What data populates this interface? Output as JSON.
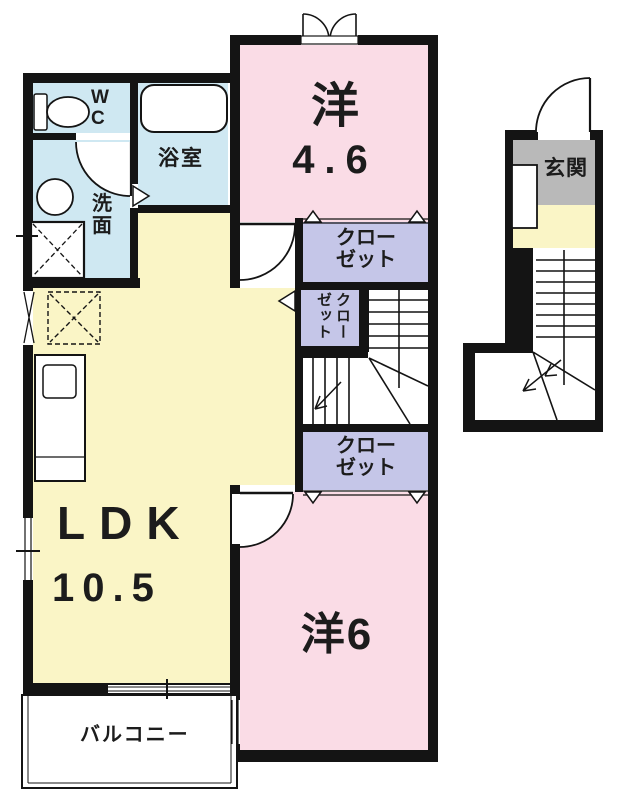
{
  "rooms": {
    "western46": {
      "label": "洋",
      "size": "4.6"
    },
    "western6": {
      "label": "洋6"
    },
    "ldk": {
      "label": "LDK",
      "size": "10.5"
    },
    "bathroom": {
      "label": "浴室"
    },
    "toilet": {
      "label": "WC"
    },
    "washroom": {
      "label": "洗面"
    },
    "balcony": {
      "label": "バルコニー"
    },
    "entrance": {
      "label": "玄関"
    },
    "closet_upper": {
      "label": "クローゼット"
    },
    "closet_hall": {
      "label": "クローゼット"
    },
    "closet_lower": {
      "label": "クローゼット"
    }
  },
  "colors": {
    "wall": "#141414",
    "room_pink": "#fadce6",
    "room_yellow": "#faf5c6",
    "water_blue": "#cfe8f2",
    "closet_purple": "#c5c6e8",
    "entrance_gray": "#b9b9b9",
    "floor_white": "#ffffff"
  }
}
